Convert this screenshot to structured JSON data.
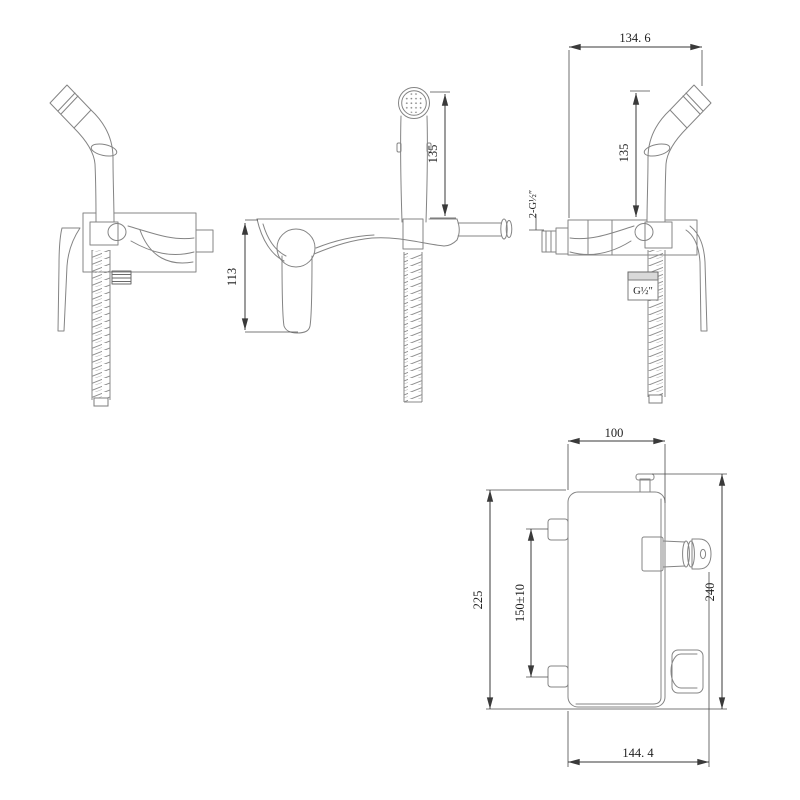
{
  "drawing": {
    "colors": {
      "background": "#ffffff",
      "product_line": "#848484",
      "dimension_line": "#3a3a3a",
      "text": "#1f1f1f"
    }
  },
  "dims": {
    "top_width": "134. 6",
    "sprayer_height_side": "135",
    "sprayer_height_front": "135",
    "handle_height": "113",
    "inlet_thread": "2-G½″",
    "hose_thread": "G½″",
    "plate_width": "100",
    "plate_height": "225",
    "inlet_spacing": "150±10",
    "overall_height": "240",
    "overall_depth": "144. 4"
  }
}
